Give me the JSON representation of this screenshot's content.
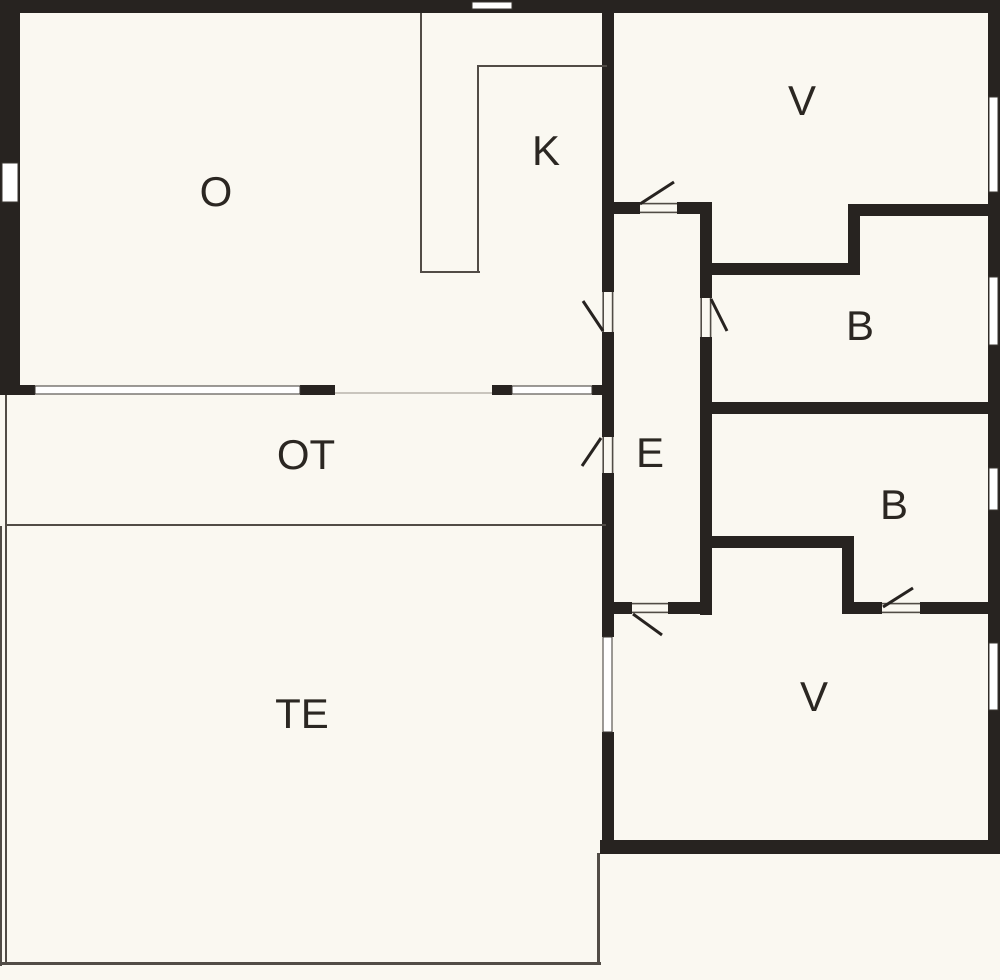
{
  "floorplan": {
    "colors": {
      "wall": "#272320",
      "bg": "#FAF8F1",
      "window": "#FFFFFF",
      "label": "#2B2722",
      "thin": "#514C46",
      "threshold": "#C9C5BD"
    },
    "rooms": {
      "living": {
        "label": "O"
      },
      "kitchen": {
        "label": "K"
      },
      "bedroom_ne": {
        "label": "V"
      },
      "bath_upper": {
        "label": "B"
      },
      "entry": {
        "label": "E"
      },
      "passage": {
        "label": "OT"
      },
      "bath_lower": {
        "label": "B"
      },
      "bedroom_se": {
        "label": "V"
      },
      "terrace": {
        "label": "TE"
      }
    }
  }
}
